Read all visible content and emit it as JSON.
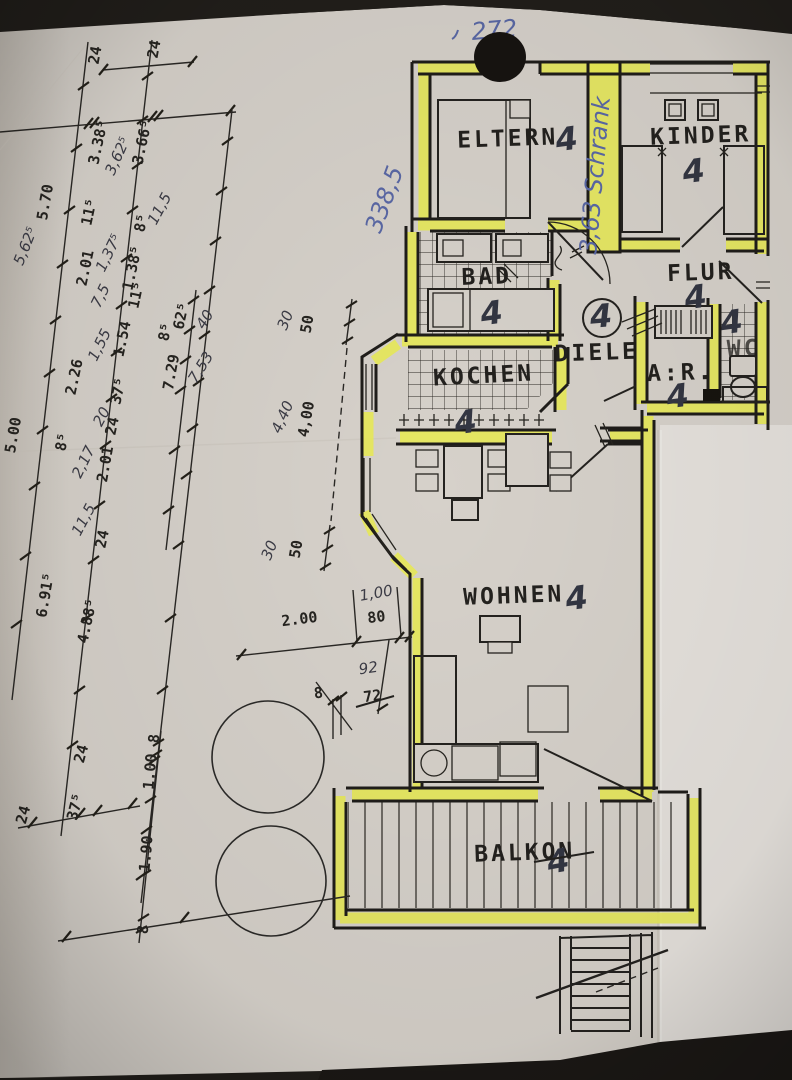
{
  "colors": {
    "paper": "#d6d1ca",
    "highlighter_yellow": "#e9eb52",
    "ink": "#1f1d1a",
    "pen_blue": "#5a68a5",
    "pencil": "#333642",
    "background": "#211e1a"
  },
  "annotations": {
    "width_note": "272",
    "depth_note": "338,5",
    "schrank_note": "3,63 Schrank"
  },
  "rooms": {
    "eltern": {
      "label": "ELTERN",
      "mark": "4"
    },
    "kinder": {
      "label": "KINDER",
      "mark": "4"
    },
    "bad": {
      "label": "BAD",
      "mark": "4"
    },
    "flur": {
      "label": "FLUR",
      "mark": "4"
    },
    "diele": {
      "label": "DIELE",
      "mark": "4"
    },
    "kochen": {
      "label": "KOCHEN",
      "mark": "4"
    },
    "abstellraum": {
      "label": "A:R.",
      "mark": "4"
    },
    "wc": {
      "label": "WC",
      "mark": "4"
    },
    "wohnen": {
      "label": "WOHNEN",
      "mark": "4"
    },
    "balkon": {
      "label": "BALKON",
      "mark": "4"
    }
  },
  "dims": {
    "left": [
      "24",
      "24",
      "3.38⁵",
      "3,62⁵",
      "3.66⁵",
      "5.70",
      "11⁵",
      "8⁵",
      "11,5",
      "5,62⁵",
      "2.01",
      "1,37⁵",
      "1.38⁵",
      "7,5",
      "11⁵",
      "1,55",
      "1.54",
      "62⁵",
      "8⁵",
      "40",
      "2.26",
      "7.29",
      "7,53",
      "37⁵",
      "20",
      "24",
      "2,17",
      "2.01",
      "8⁵",
      "5.00",
      "11,5",
      "24",
      "6.91⁵",
      "4.88⁵",
      "24",
      "37⁵",
      "24",
      "8",
      "1.00",
      "1.90",
      "8"
    ],
    "mid": [
      "30",
      "50",
      "4,40",
      "4,00",
      "30",
      "50",
      "2.00",
      "1,00",
      "80",
      "92",
      "72",
      "8"
    ]
  }
}
